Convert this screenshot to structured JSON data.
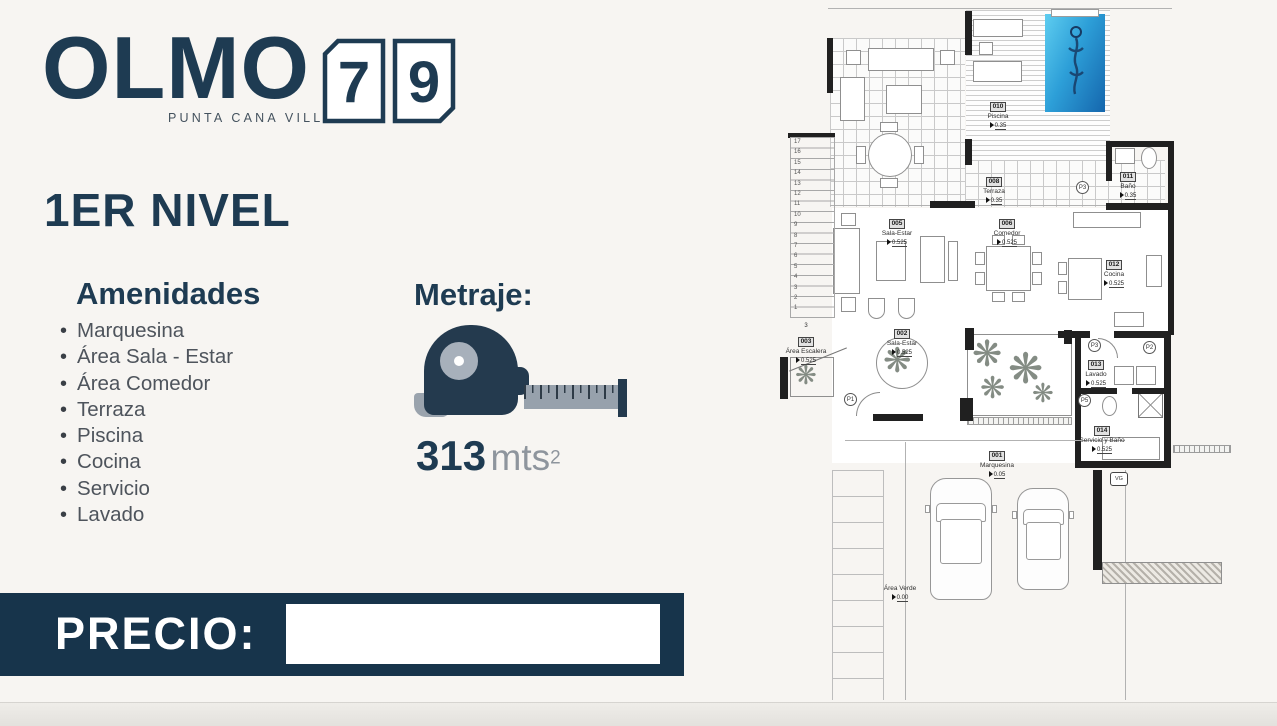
{
  "colors": {
    "navy": "#1e3b52",
    "price_bar": "#17344b",
    "pool_blue": "#2d9fd8",
    "background": "#f7f5f2"
  },
  "brand": {
    "name": "OLMO",
    "subtitle": "PUNTA CANA VILLAGE",
    "unit_digit_1": "7",
    "unit_digit_2": "9"
  },
  "level_title": "1ER NIVEL",
  "amenities": {
    "title": "Amenidades",
    "items": [
      "Marquesina",
      "Área Sala - Estar",
      "Área Comedor",
      "Terraza",
      "Piscina",
      "Cocina",
      "Servicio",
      "Lavado"
    ]
  },
  "metraje": {
    "title": "Metraje:",
    "value": "313",
    "unit": "mts",
    "exponent": "2"
  },
  "price": {
    "label": "PRECIO:",
    "value": ""
  },
  "floorplan": {
    "rooms": [
      {
        "code": "010",
        "name": "Piscina",
        "elev": "0.35"
      },
      {
        "code": "008",
        "name": "Terraza",
        "elev": "0.35"
      },
      {
        "code": "011",
        "name": "Baño",
        "elev": "0.35"
      },
      {
        "code": "005",
        "name": "Sala-Estar",
        "elev": "0.525"
      },
      {
        "code": "006",
        "name": "Comedor",
        "elev": "0.525"
      },
      {
        "code": "012",
        "name": "Cocina",
        "elev": "0.525"
      },
      {
        "code": "003",
        "name": "Área Escalera",
        "elev": "0.525"
      },
      {
        "code": "002",
        "name": "Sala-Estar",
        "elev": "0.525"
      },
      {
        "code": "013",
        "name": "Lavado",
        "elev": "0.525"
      },
      {
        "code": "014",
        "name": "Servicio y Baño",
        "elev": "0.525"
      },
      {
        "code": "001",
        "name": "Marquesina",
        "elev": "0.05"
      },
      {
        "code": "",
        "name": "Área Verde",
        "elev": "0.00"
      }
    ],
    "doors": [
      {
        "label": "P3"
      },
      {
        "label": "P3"
      },
      {
        "label": "P2"
      },
      {
        "label": "P5"
      },
      {
        "label": "P1"
      }
    ],
    "stair_note": "3",
    "stair_numbers": [
      "17",
      "16",
      "15",
      "14",
      "13",
      "12",
      "11",
      "10",
      "9",
      "8",
      "7",
      "6",
      "5",
      "4",
      "3",
      "2",
      "1"
    ],
    "garage_marker": "VG"
  }
}
